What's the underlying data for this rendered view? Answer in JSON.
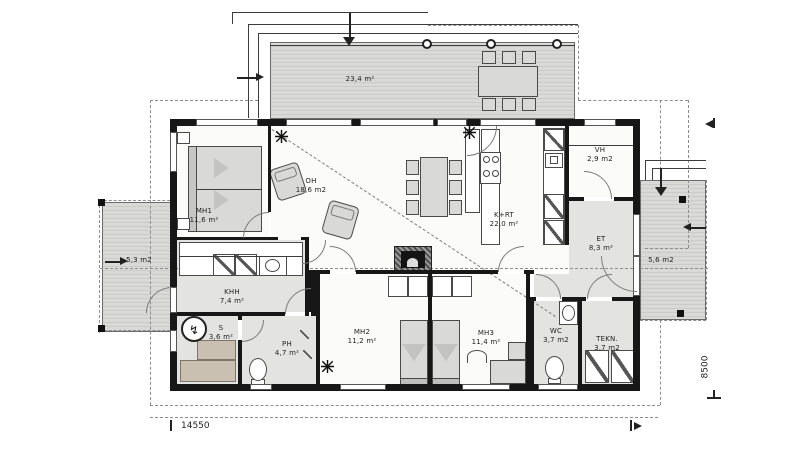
{
  "rooms": {
    "mh1": {
      "name": "MH1",
      "area": "11,6 m²"
    },
    "oh": {
      "name": "OH",
      "area": "18,6 m2"
    },
    "krt": {
      "name": "K+RT",
      "area": "22,0 m²"
    },
    "vh": {
      "name": "VH",
      "area": "2,9 m2"
    },
    "et": {
      "name": "ET",
      "area": "8,3 m²"
    },
    "khh": {
      "name": "KHH",
      "area": "7,4 m²"
    },
    "s": {
      "name": "S",
      "area": "3,6 m²"
    },
    "ph": {
      "name": "PH",
      "area": "4,7 m²"
    },
    "mh2": {
      "name": "MH2",
      "area": "11,2 m²"
    },
    "mh3": {
      "name": "MH3",
      "area": "11,4 m²"
    },
    "wc": {
      "name": "WC",
      "area": "3,7 m2"
    },
    "tekn": {
      "name": "TEKN.",
      "area": "3,7 m2"
    },
    "terrace_top": {
      "area": "23,4 m²"
    },
    "terrace_left": {
      "area": "5,3 m2"
    },
    "terrace_right": {
      "area": "5,6 m2"
    }
  },
  "dims": {
    "width": "14550",
    "depth": "8500"
  },
  "colors": {
    "wall": "#171717",
    "deck": "#d9d9d7",
    "wetroom": "#e3e3e1",
    "room": "#fbfbf9"
  }
}
